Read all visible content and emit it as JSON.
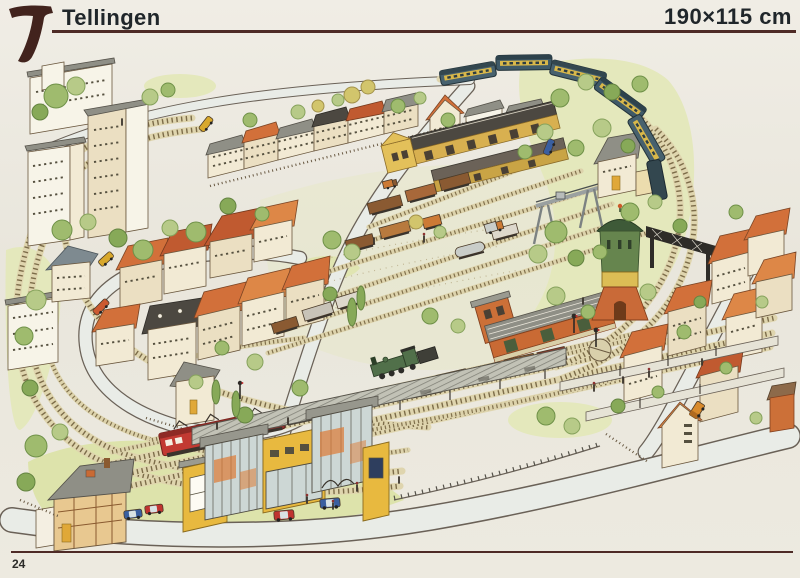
{
  "page": {
    "plan_number": "7",
    "title": "Tellingen",
    "dimensions": "190×115 cm",
    "page_number": "24"
  },
  "illustration": {
    "alt": "Hand-drawn watercolour bird's-eye view of the Tellingen model railway layout: town with apartment blocks and row houses, through station with modern yellow entrance buildings, goods yard with sheds, gantry crane, water tower, footbridge and trains",
    "labels": {
      "tank_car": "FINA"
    },
    "colors": {
      "rule": "#4e2b26",
      "ink": "#20262a",
      "station_yellow": "#e8b93f",
      "roof_orange": "#d2703a",
      "loco_red": "#c23a32",
      "coach_blue": "#47616e",
      "tank_blue": "#3c5fa0",
      "tree_green": "#9fbb6e",
      "water_tower_green": "#66854e"
    }
  }
}
